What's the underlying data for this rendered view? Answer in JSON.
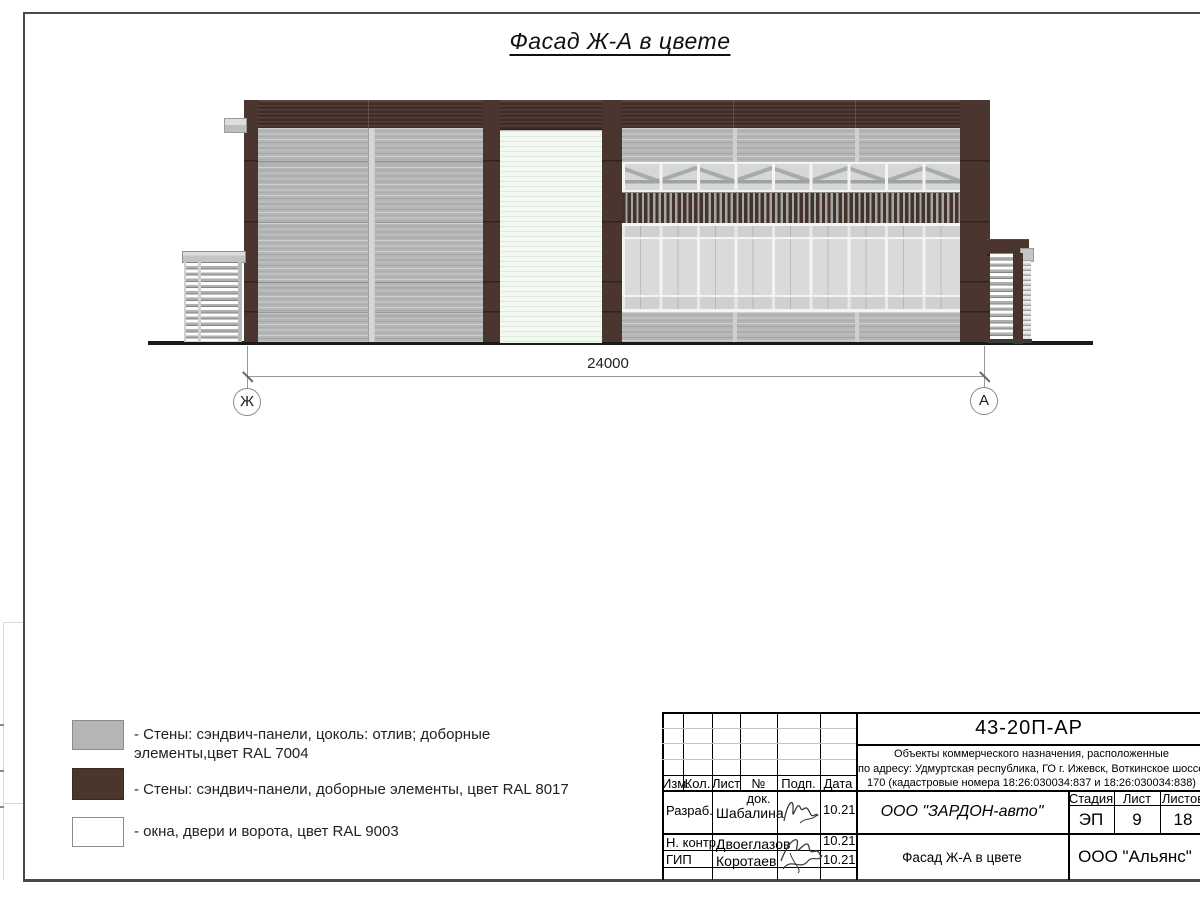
{
  "sheet": {
    "title": "Фасад Ж-А в цвете"
  },
  "drawing": {
    "dimension_label": "24000",
    "axis_left_label": "Ж",
    "axis_right_label": "А"
  },
  "legend": {
    "items": [
      {
        "color": "#b4b6b5",
        "label": "- Стены: сэндвич-панели, цоколь: отлив; доборные\nэлементы,цвет RAL 7004"
      },
      {
        "color": "#4b362e",
        "label": "- Стены: сэндвич-панели, доборные элементы, цвет RAL 8017"
      },
      {
        "color": "#ffffff",
        "label": "- окна, двери и ворота, цвет RAL 9003"
      }
    ]
  },
  "title_block": {
    "doc_number": "43-20П-АР",
    "project_description": "Объекты коммерческого назначения, расположенные\nпо адресу: Удмуртская республика, ГО г. Ижевск, Воткинское шоссе,\n170 (кадастровые номера 18:26:030034:837 и 18:26:030034:838)",
    "columns": {
      "izm": "Изм.",
      "kol": "Кол.",
      "list": "Лист",
      "doc": "№ док.",
      "podp": "Подп.",
      "data": "Дата"
    },
    "stage": {
      "label": "Стадия",
      "value": "ЭП"
    },
    "sheet_no": {
      "label": "Лист",
      "value": "9"
    },
    "sheets_total": {
      "label": "Листов",
      "value": "18"
    },
    "client": "ООО \"ЗАРДОН-авто\"",
    "sheet_name": "Фасад Ж-А в цвете",
    "organization": "ООО \"Альянс\"",
    "signatures": [
      {
        "role": "Разраб.",
        "name": "Шабалина",
        "date": "10.21"
      },
      {
        "role": "Н. контр.",
        "name": "Двоеглазов",
        "date": "10.21"
      },
      {
        "role": "ГИП",
        "name": "Коротаев",
        "date": "10.21"
      }
    ]
  },
  "colors": {
    "ral7004_gray": "#b4b6b5",
    "ral8017_brown": "#4a352e",
    "ral9003_white": "#f4f8f3",
    "frame_line": "#4a4a4a"
  }
}
